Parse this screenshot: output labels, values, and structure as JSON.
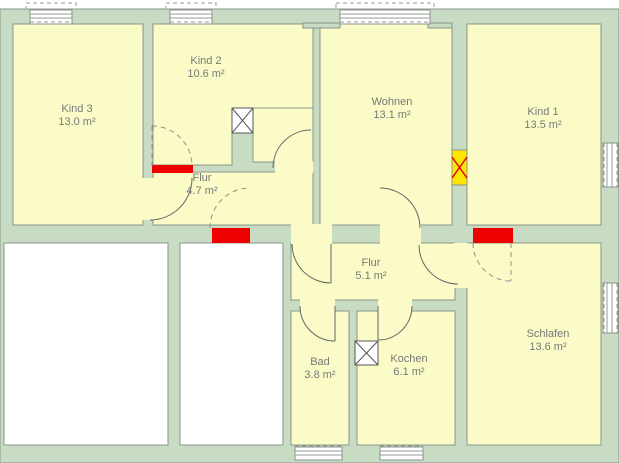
{
  "rooms": {
    "kind3": {
      "name": "Kind 3",
      "area": "13.0 m²"
    },
    "kind2": {
      "name": "Kind 2",
      "area": "10.6 m²"
    },
    "wohnen": {
      "name": "Wohnen",
      "area": "13.1 m²"
    },
    "kind1": {
      "name": "Kind 1",
      "area": "13.5 m²"
    },
    "flur_upper": {
      "name": "Flur",
      "area": "4.7 m²"
    },
    "flur_lower": {
      "name": "Flur",
      "area": "5.1 m²"
    },
    "bad": {
      "name": "Bad",
      "area": "3.8 m²"
    },
    "kochen": {
      "name": "Kochen",
      "area": "6.1 m²"
    },
    "schlafen": {
      "name": "Schlafen",
      "area": "13.6 m²"
    }
  },
  "colors": {
    "wall": "#c8dbc3",
    "room_fill": "#fbfbc7",
    "door_marker_red": "#ee0000",
    "door_marker_yellow": "#ffe400",
    "neighbor_room_fill": "#ffffff",
    "label_text": "#787878"
  }
}
